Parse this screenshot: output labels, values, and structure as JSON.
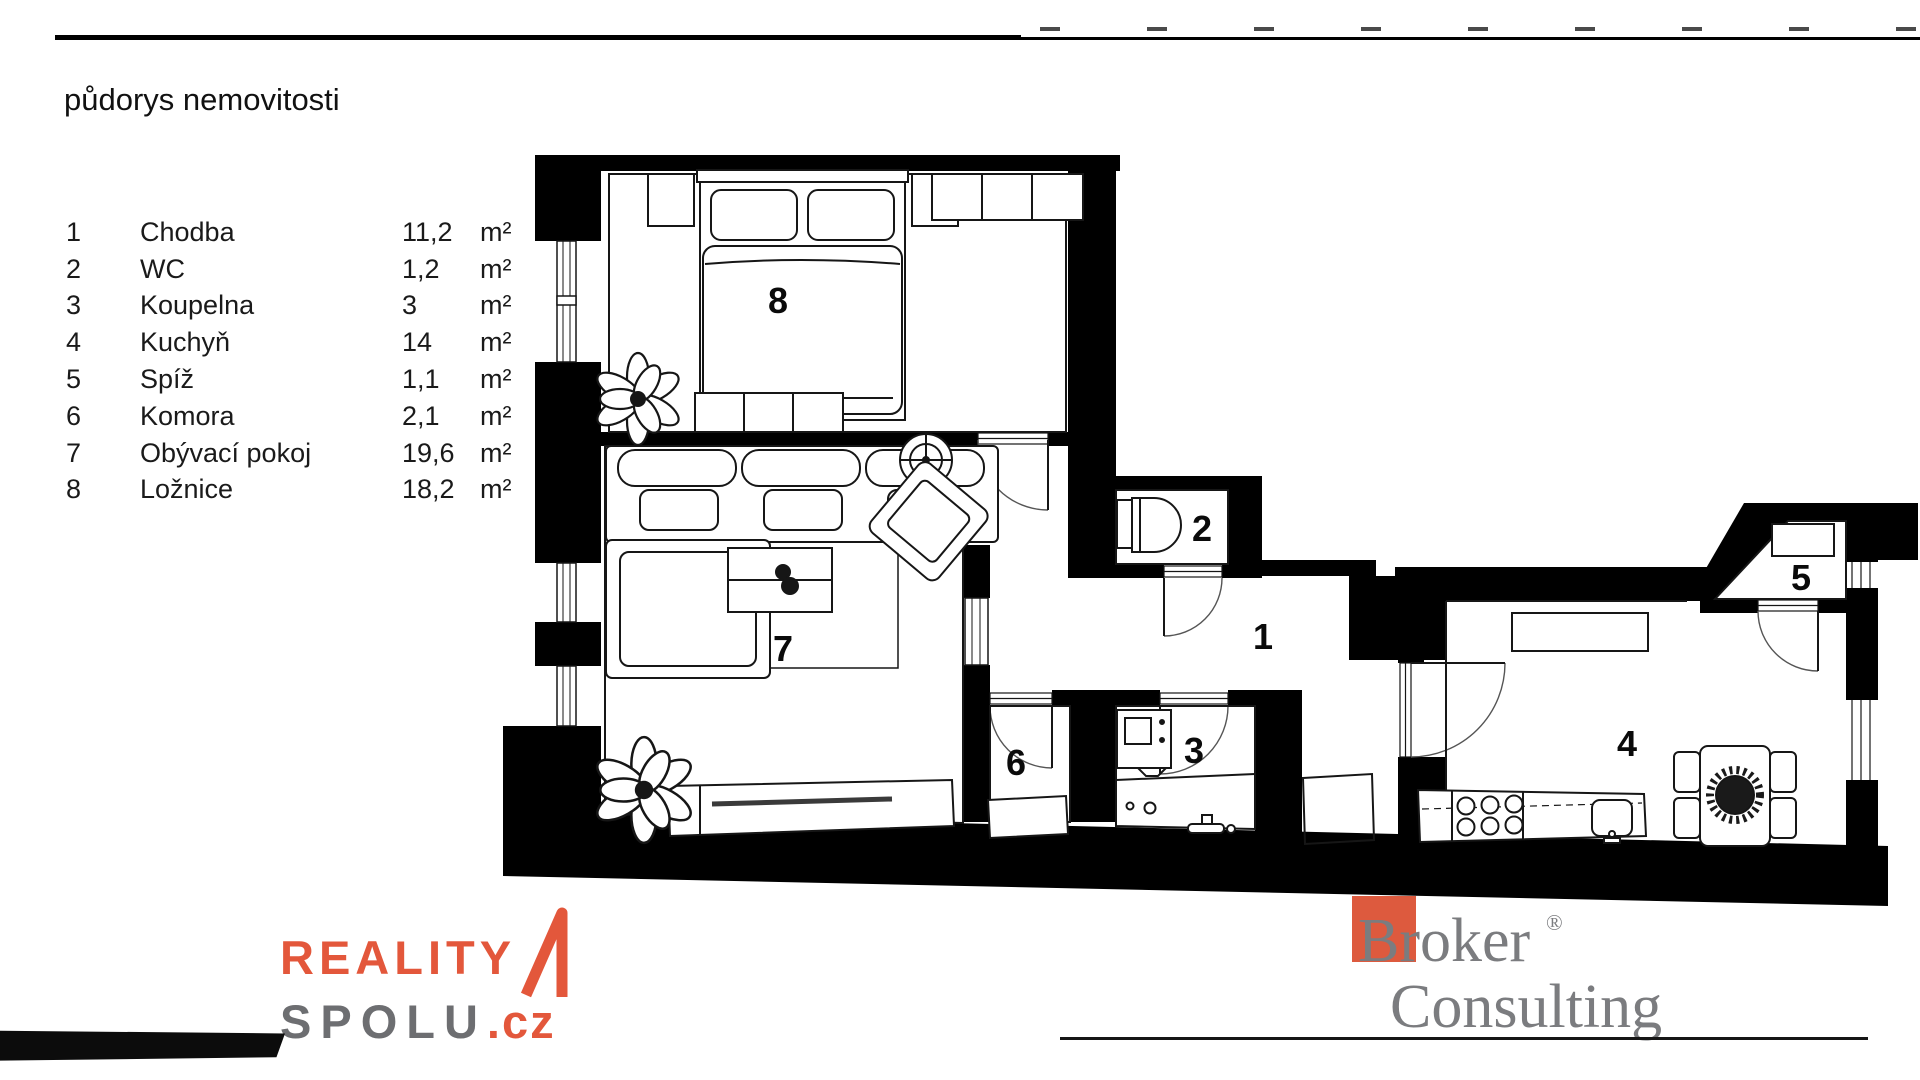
{
  "page": {
    "title": "půdorys nemovitosti"
  },
  "legend": {
    "unit": "m²",
    "rows": [
      {
        "num": "1",
        "name": "Chodba",
        "area": "11,2"
      },
      {
        "num": "2",
        "name": "WC",
        "area": "1,2"
      },
      {
        "num": "3",
        "name": "Koupelna",
        "area": "3"
      },
      {
        "num": "4",
        "name": "Kuchyň",
        "area": "14"
      },
      {
        "num": "5",
        "name": "Spíž",
        "area": "1,1"
      },
      {
        "num": "6",
        "name": "Komora",
        "area": "2,1"
      },
      {
        "num": "7",
        "name": "Obývací pokoj",
        "area": "19,6"
      },
      {
        "num": "8",
        "name": "Ložnice",
        "area": "18,2"
      }
    ]
  },
  "plan": {
    "room_labels": {
      "r1": "1",
      "r2": "2",
      "r3": "3",
      "r4": "4",
      "r5": "5",
      "r6": "6",
      "r7": "7",
      "r8": "8"
    }
  },
  "branding": {
    "reality": {
      "line1": "REALITY",
      "line2": "SPOLU",
      "tld": ".cz"
    },
    "broker": {
      "line1": "Broker",
      "line2": "Consulting",
      "reg": "®"
    }
  },
  "colors": {
    "wall": "#000000",
    "reality_orange": "#e3573b",
    "reality_gray": "#6d6e71",
    "broker_red": "#dd5a3e",
    "broker_gray": "#7b7c7f"
  }
}
